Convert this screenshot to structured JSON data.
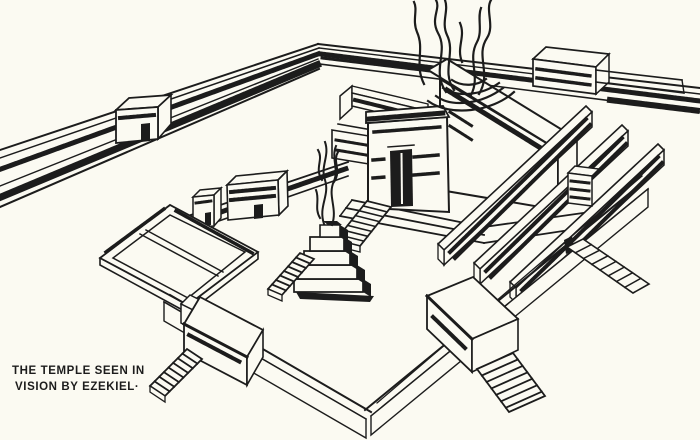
{
  "illustration": {
    "title": "The Temple Seen in Vision by Ezekiel",
    "caption": {
      "line1": "THE TEMPLE SEEN IN",
      "line2": "VISION BY EZEKIEL·"
    },
    "colors": {
      "ink": "#1c1c1c",
      "paper": "#fbfaf2"
    },
    "depicted": [
      "outer court wall with crenellations and gatehouses",
      "inner court wall with gatehouses",
      "corner chamber courts",
      "altar of burnt offering with rising smoke",
      "temple sanctuary with porch, doorway and stairs",
      "rows of side chambers",
      "stairways on the walls"
    ]
  }
}
